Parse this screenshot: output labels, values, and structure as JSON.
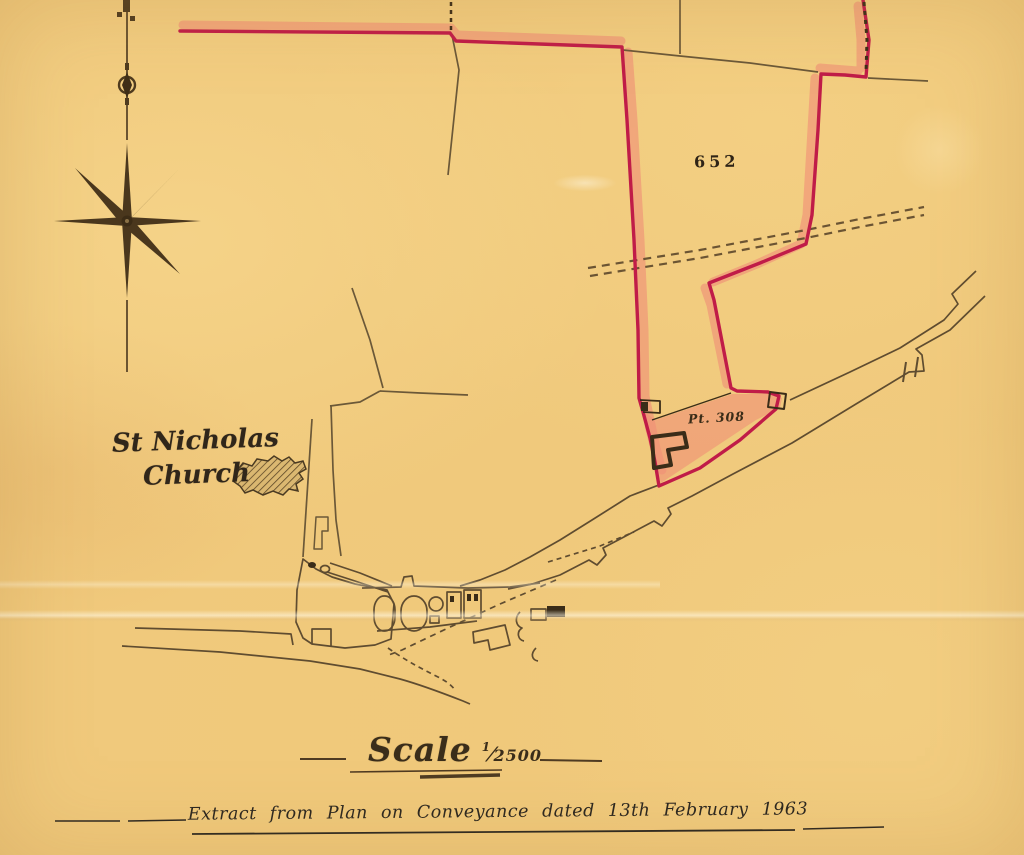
{
  "map": {
    "parcel_652_label": "652",
    "parcel_308_label": "Pt. 308",
    "church": {
      "line1": "St Nicholas",
      "line2": "Church"
    },
    "scale": {
      "word": "Scale",
      "numerator": "1",
      "separator": "⁄",
      "denominator": "2500"
    },
    "footer_note": "Extract from Plan on Conveyance dated 13th February 1963",
    "icons": {
      "compass": "compass-rose-icon",
      "church_footprint": "church-building-icon"
    },
    "colors": {
      "paper": "#f0c97c",
      "boundary_red": "#c01c48",
      "boundary_wash": "#f09077",
      "ink_sepia": "#6b5838",
      "ink_dark": "#3a2c18"
    }
  }
}
